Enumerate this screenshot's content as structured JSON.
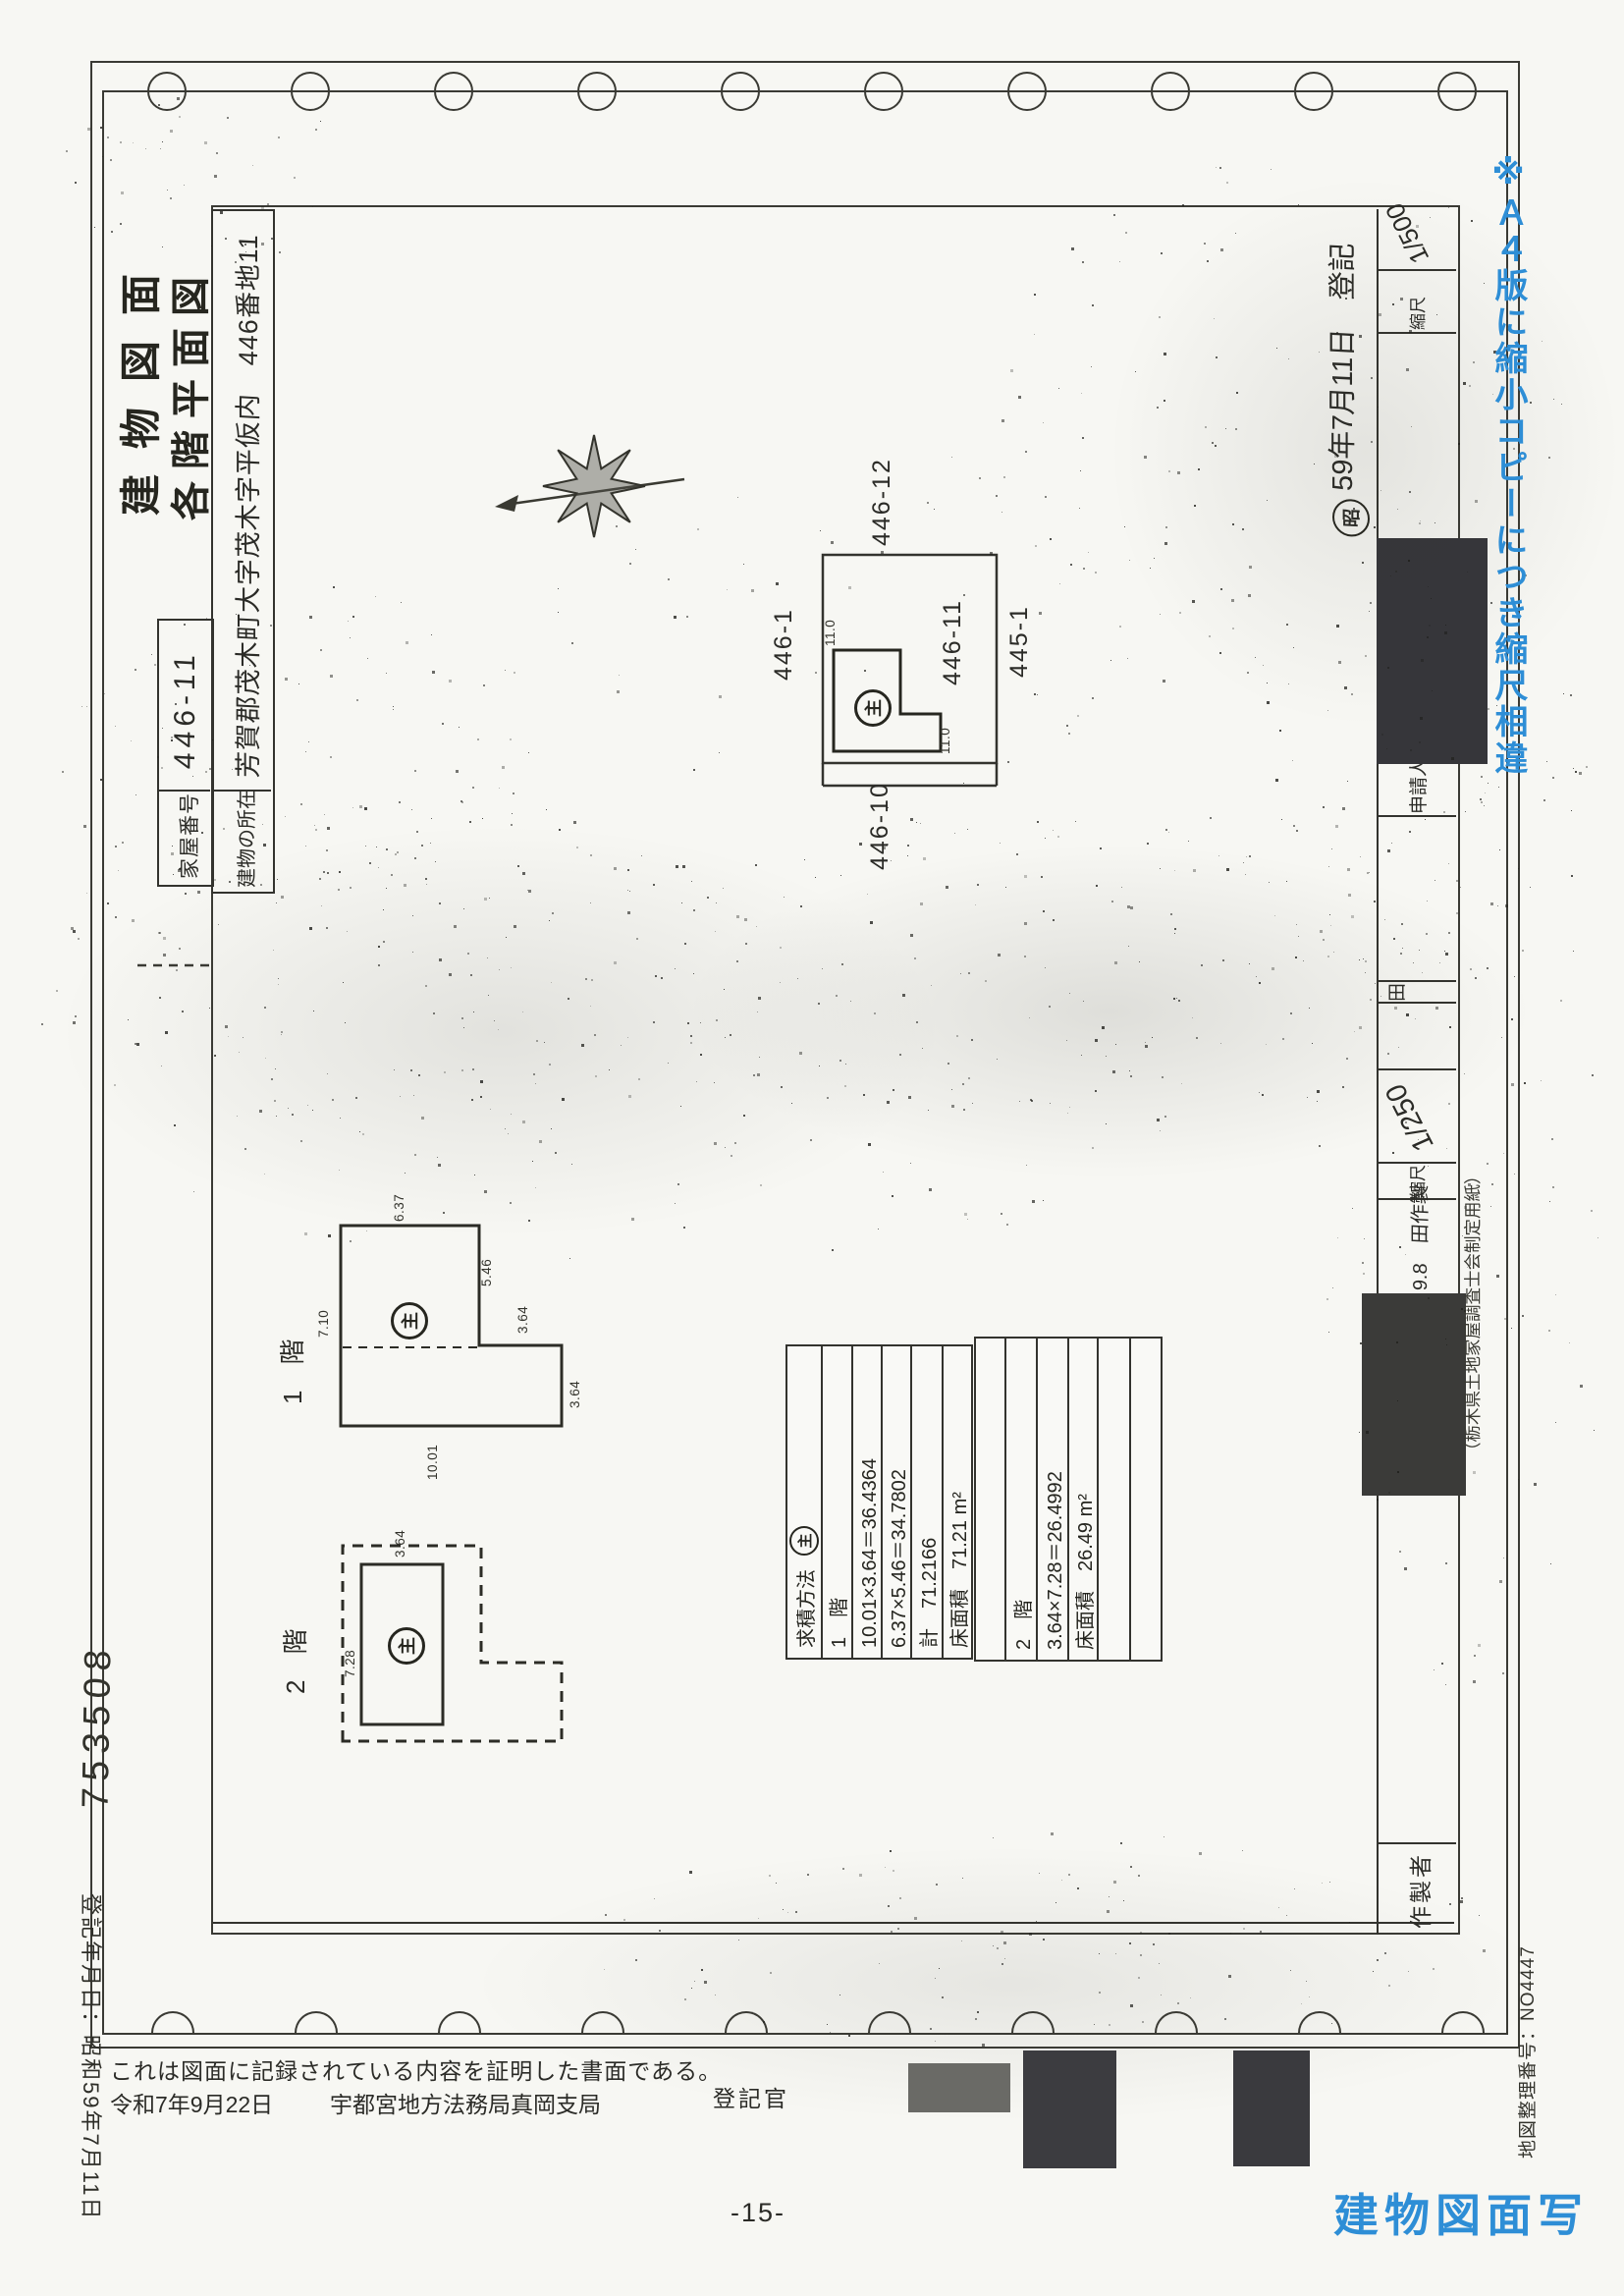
{
  "titles": {
    "main": "建物図面",
    "sub": "各階平面図"
  },
  "header_fields": {
    "house_number_label": "家屋番号",
    "house_number_value": "446-11",
    "location_label": "建物の所在",
    "location_value": "芳賀郡茂木町大字茂木字平仮内　446番地11"
  },
  "site_plan": {
    "parcels": [
      "446-1",
      "446-12",
      "446-11",
      "445-1",
      "446-10"
    ],
    "dim_top": "11.0",
    "dim_bottom": "11.0",
    "main_mark": "主"
  },
  "floor1": {
    "label": "1　階",
    "dims": [
      "7.10",
      "6.37",
      "5.46",
      "3.64",
      "3.64",
      "10.01"
    ]
  },
  "floor2": {
    "label": "2　階",
    "dims": [
      "3.64",
      "7.28"
    ]
  },
  "calc_table": {
    "main_mark": "主",
    "block1": [
      "求積方法",
      "1　階",
      "10.01×3.64＝36.4364",
      "6.37×5.46＝34.7802",
      "計　71.2166",
      "床面積　71.21 m²"
    ],
    "block2": [
      "",
      "2　階",
      "3.64×7.28＝26.4992",
      "床面積　26.49 m²",
      "",
      ""
    ]
  },
  "bottom_row": {
    "maker_label": "作製者",
    "maker_note": "9.8　田作製",
    "scale_label_left": "縮尺",
    "scale_value_left": "1/250",
    "small_cell": "田",
    "applicant_label": "申請人",
    "scale_label_right": "縮尺",
    "scale_value_right": "1/500",
    "registered_prefix": "昭",
    "registered_note": "59年7月11日　登記"
  },
  "margins": {
    "file_number": "753508",
    "paper_note": "（栃木県土地家屋調査士会制定用紙）",
    "map_number": "地図整理番号：NO4447"
  },
  "certification": {
    "registration_date_note": "登記年月日：昭和59年7月11日",
    "statement": "これは図面に記録されている内容を証明した書面である。",
    "date": "令和7年9月22日",
    "office": "宇都宮地方法務局真岡支局",
    "registrar_label": "登記官",
    "page_number": "-15-",
    "copy_stamp": "建物図面写",
    "scale_note": "※Ａ４版に縮小コピーにつき縮尺相違"
  }
}
